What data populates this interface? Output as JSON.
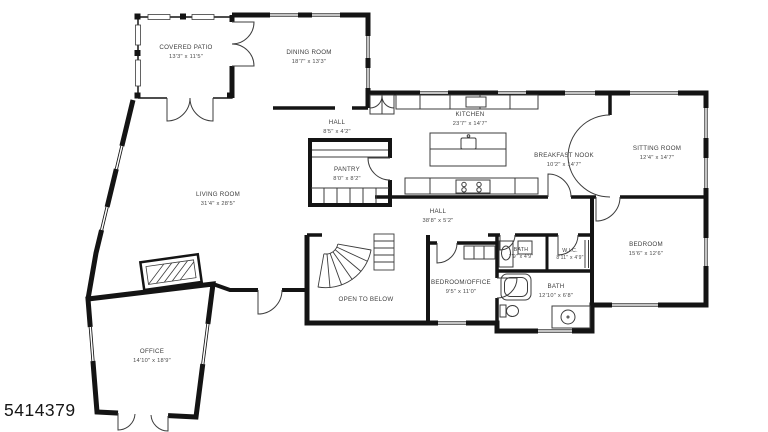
{
  "plan": {
    "mls_number": "5414379",
    "rooms": [
      {
        "id": "covered-patio",
        "name": "COVERED PATIO",
        "dims": "13'3\" x 11'5\""
      },
      {
        "id": "dining-room",
        "name": "DINING ROOM",
        "dims": "18'7\" x 13'3\""
      },
      {
        "id": "hall-upper",
        "name": "HALL",
        "dims": "8'5\" x 4'2\""
      },
      {
        "id": "kitchen",
        "name": "KITCHEN",
        "dims": "23'7\" x 14'7\""
      },
      {
        "id": "pantry",
        "name": "PANTRY",
        "dims": "8'0\" x 8'2\""
      },
      {
        "id": "breakfast-nook",
        "name": "BREAKFAST NOOK",
        "dims": "10'2\" x 14'7\""
      },
      {
        "id": "sitting-room",
        "name": "SITTING ROOM",
        "dims": "12'4\" x 14'7\""
      },
      {
        "id": "living-room",
        "name": "LIVING ROOM",
        "dims": "31'4\" x 28'5\""
      },
      {
        "id": "hall-main",
        "name": "HALL",
        "dims": "38'8\" x 5'2\""
      },
      {
        "id": "bedroom",
        "name": "BEDROOM",
        "dims": "15'6\" x 12'6\""
      },
      {
        "id": "bath-hall",
        "name": "BATH",
        "dims": "7'9\" x 4'9\""
      },
      {
        "id": "wic",
        "name": "W.I.C.",
        "dims": "8'11\" x 4'9\""
      },
      {
        "id": "bedroom-office",
        "name": "BEDROOM/OFFICE",
        "dims": "9'5\" x 11'0\""
      },
      {
        "id": "bath-main",
        "name": "BATH",
        "dims": "12'10\" x 6'8\""
      },
      {
        "id": "open-to-below",
        "name": "OPEN TO BELOW",
        "dims": ""
      },
      {
        "id": "office",
        "name": "OFFICE",
        "dims": "14'10\" x 18'9\""
      }
    ],
    "colors": {
      "wall": "#141414",
      "fixture": "#3c3c3c",
      "background": "#ffffff"
    }
  }
}
